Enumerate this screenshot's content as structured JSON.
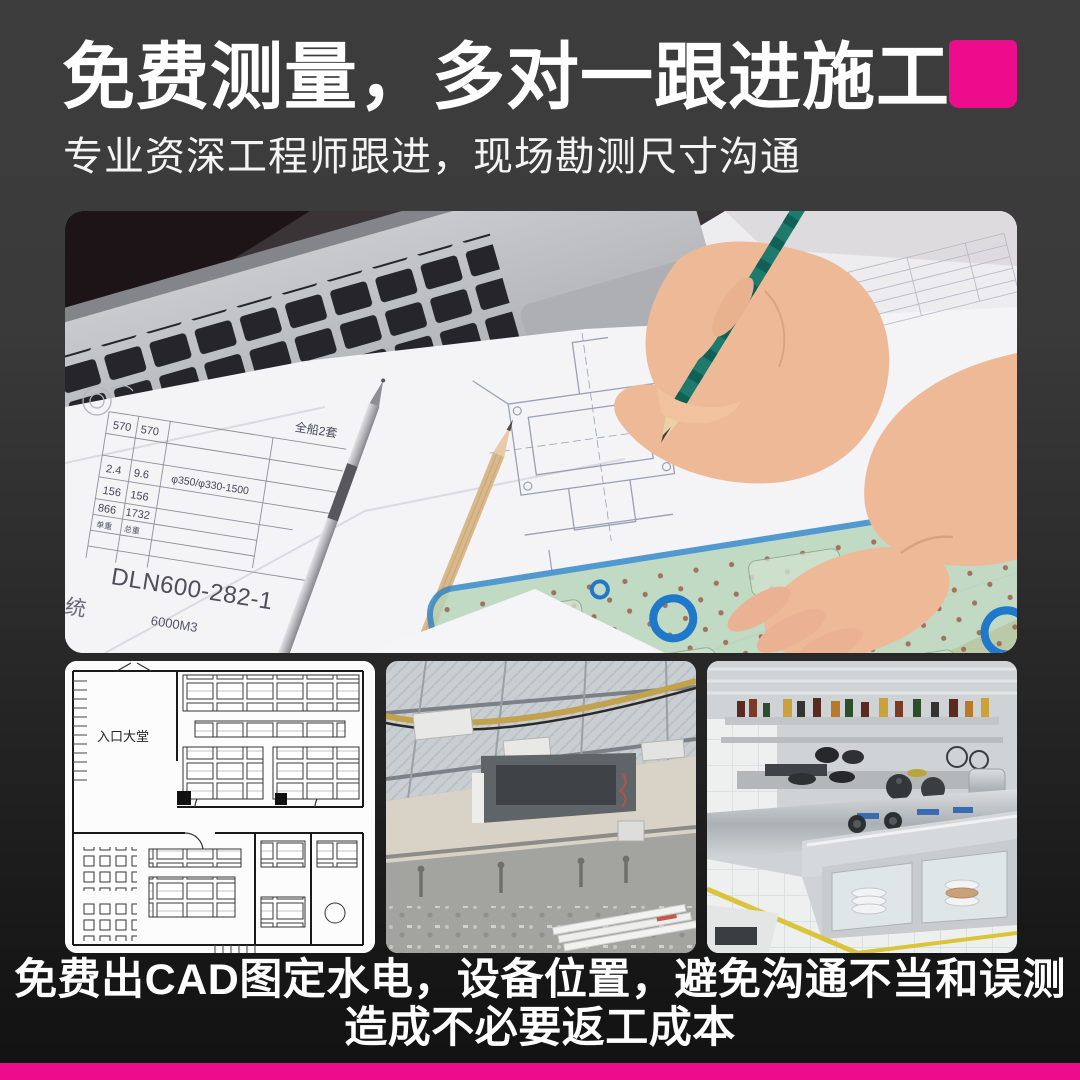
{
  "colors": {
    "accent_pink": "#EC0C8C",
    "background_top": "#3B3B3B",
    "background_bottom": "#121212",
    "text_white": "#FFFFFF"
  },
  "header": {
    "title": "免费测量，多对一跟进施工",
    "subtitle": "专业资深工程师跟进，现场勘测尺寸沟通"
  },
  "hero": {
    "alt": "工程师手持绿色铅笔在施工图纸上绘图，旁有笔记本电脑与绘图模板尺",
    "table": {
      "set_note": "全船2套",
      "r1c1": "570",
      "r1c2": "570",
      "r2c1": "2.4",
      "r2c2": "9.6",
      "spec": "φ350/φ330-1500",
      "r3c1": "156",
      "r3c2": "156",
      "r4c1": "866",
      "r4c2": "1732",
      "unit_label": "单重",
      "total_label": "总重",
      "drawing_no": "DLN600-282-1",
      "volume_note": "6000M3",
      "side_label": "系统"
    }
  },
  "gallery": {
    "items": [
      {
        "name": "cad-floor-plan",
        "alt": "CAD厨房平面布置图",
        "label": "入口大堂"
      },
      {
        "name": "construction-site",
        "alt": "施工现场水电点位",
        "label": ""
      },
      {
        "name": "finished-kitchen",
        "alt": "完工商用厨房设备",
        "label": ""
      }
    ]
  },
  "caption": {
    "line1": "免费出CAD图定水电，设备位置，避免沟通不当和误测",
    "line2": "造成不必要返工成本"
  }
}
